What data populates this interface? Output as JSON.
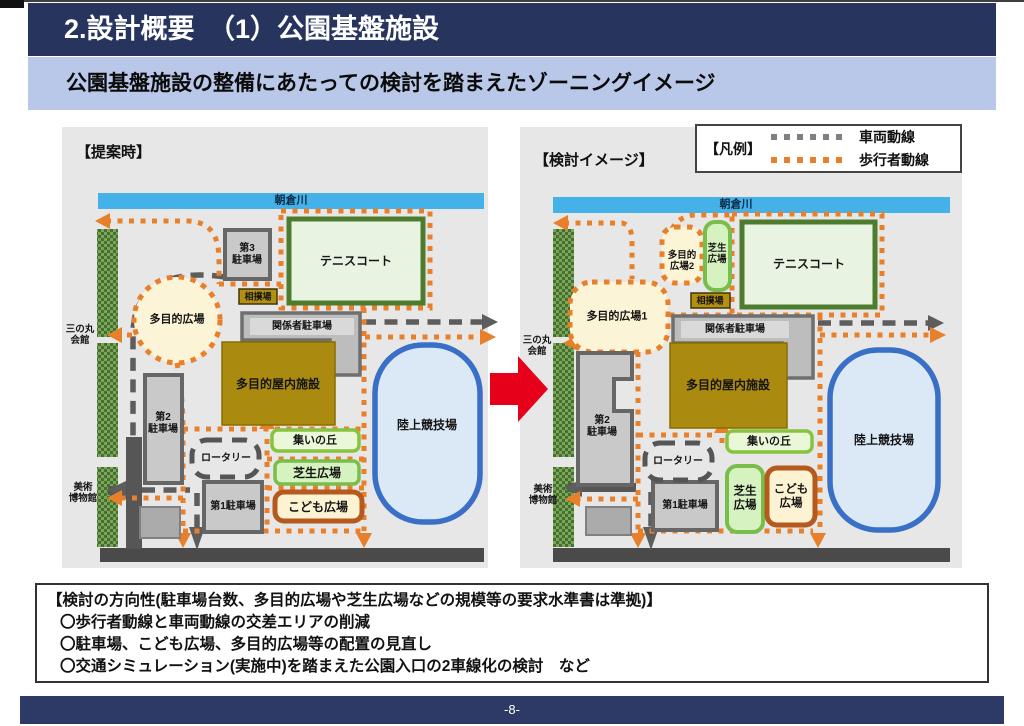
{
  "page": {
    "title": "2.設計概要　（1）公園基盤施設",
    "subtitle": "公園基盤施設の整備にあたっての検討を踏まえたゾーニングイメージ",
    "page_number": "-8-"
  },
  "legend": {
    "title": "【凡例】",
    "vehicle_label": "車両動線",
    "pedestrian_label": "歩行者動線"
  },
  "maps": {
    "left": {
      "title": "【提案時】",
      "river": "朝倉川",
      "sannomaru": "三の丸\n会館",
      "museum": "美術\n博物館",
      "parking3": "第3\n駐車場",
      "tennis": "テニスコート",
      "sumo": "相撲場",
      "plaza": "多目的広場",
      "staff_parking": "関係者駐車場",
      "indoor": "多目的屋内施設",
      "stadium": "陸上競技場",
      "hill": "集いの丘",
      "rotary": "ロータリー",
      "lawn": "芝生広場",
      "kids": "こども広場",
      "parking1": "第1駐車場",
      "parking2": "第2\n駐車場"
    },
    "right": {
      "title": "【検討イメージ】",
      "river": "朝倉川",
      "sannomaru": "三の丸\n会館",
      "museum": "美術\n博物館",
      "plaza2": "多目的\n広場2",
      "lawn_top": "芝生\n広場",
      "tennis": "テニスコート",
      "sumo": "相撲場",
      "plaza1": "多目的広場1",
      "staff_parking": "関係者駐車場",
      "indoor": "多目的屋内施設",
      "stadium": "陸上競技場",
      "hill": "集いの丘",
      "rotary": "ロータリー",
      "lawn": "芝生\n広場",
      "kids": "こども\n広場",
      "parking1": "第1駐車場",
      "parking2": "第2\n駐車場"
    }
  },
  "notes": {
    "heading": "【検討の方向性(駐車場台数、多目的広場や芝生広場などの規模等の要求水準書は準拠)】",
    "items": [
      "〇歩行者動線と車両動線の交差エリアの削減",
      "〇駐車場、こども広場、多目的広場等の配置の見直し",
      "〇交通シミュレーション(実施中)を踏まえた公園入口の2車線化の検討　など"
    ]
  },
  "colors": {
    "title_bar": "#27345e",
    "subtitle_bar": "#b9c7e8",
    "footer_bar": "#2d3a66",
    "panel_bg": "#e7e7e7",
    "pedestrian_line": "#e8802b",
    "vehicle_line": "#5d5d5d",
    "river": "#45b1e9",
    "red_arrow": "#e60019"
  }
}
